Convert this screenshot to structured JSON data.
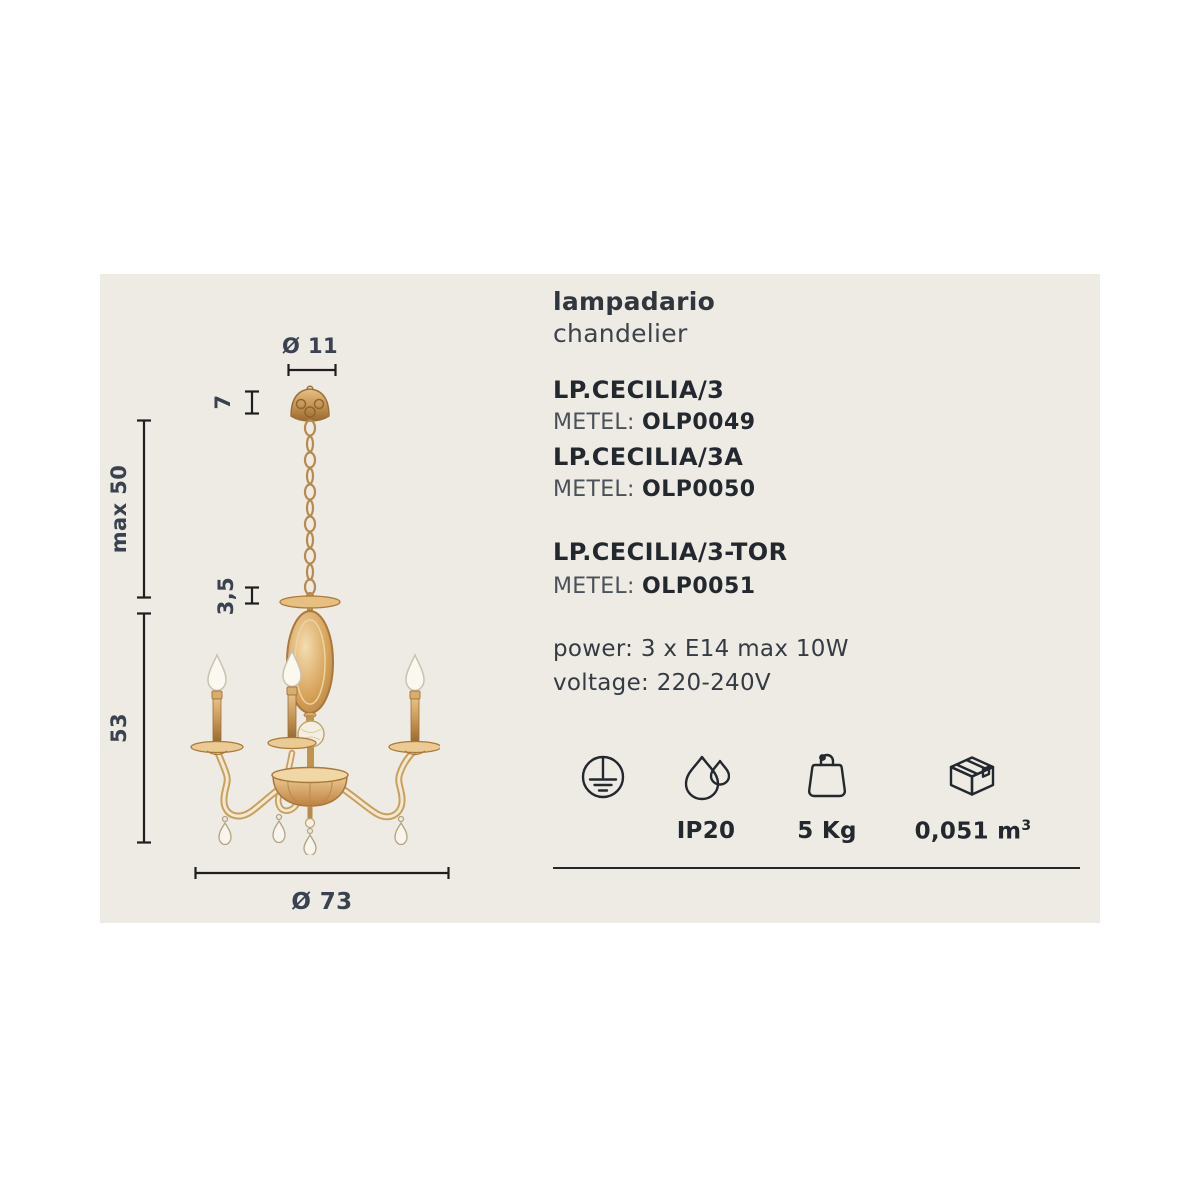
{
  "title": {
    "it": "lampadario",
    "en": "chandelier"
  },
  "variants": [
    {
      "name": "LP.CECILIA/3",
      "metel_label": "METEL:",
      "code": "OLP0049"
    },
    {
      "name": "LP.CECILIA/3A",
      "metel_label": "METEL:",
      "code": "OLP0050"
    },
    {
      "name": "LP.CECILIA/3-TOR",
      "metel_label": "METEL:",
      "code": "OLP0051"
    }
  ],
  "electrical": {
    "power": "power: 3 x E14 max 10W",
    "voltage": "voltage: 220-240V"
  },
  "dimensions": {
    "canopy_diameter": "Ø 11",
    "canopy_height": "7",
    "suspension_max": "max 50",
    "stem_gap": "3,5",
    "body_height": "53",
    "diameter": "Ø 73"
  },
  "badges": {
    "ip": "IP20",
    "weight": "5 Kg",
    "volume": "0,051 m",
    "volume_sup": "3"
  },
  "icons": {
    "ground": "earth-ground-icon",
    "drops": "water-drops-icon",
    "weight": "weight-icon",
    "box": "package-box-icon"
  },
  "colors": {
    "panel_bg": "#edebe4",
    "text": "#2e343c",
    "dim_text": "#3a4250",
    "line": "#1e1e1e",
    "gold": "#c79a58",
    "amber": "#d9a75f"
  }
}
